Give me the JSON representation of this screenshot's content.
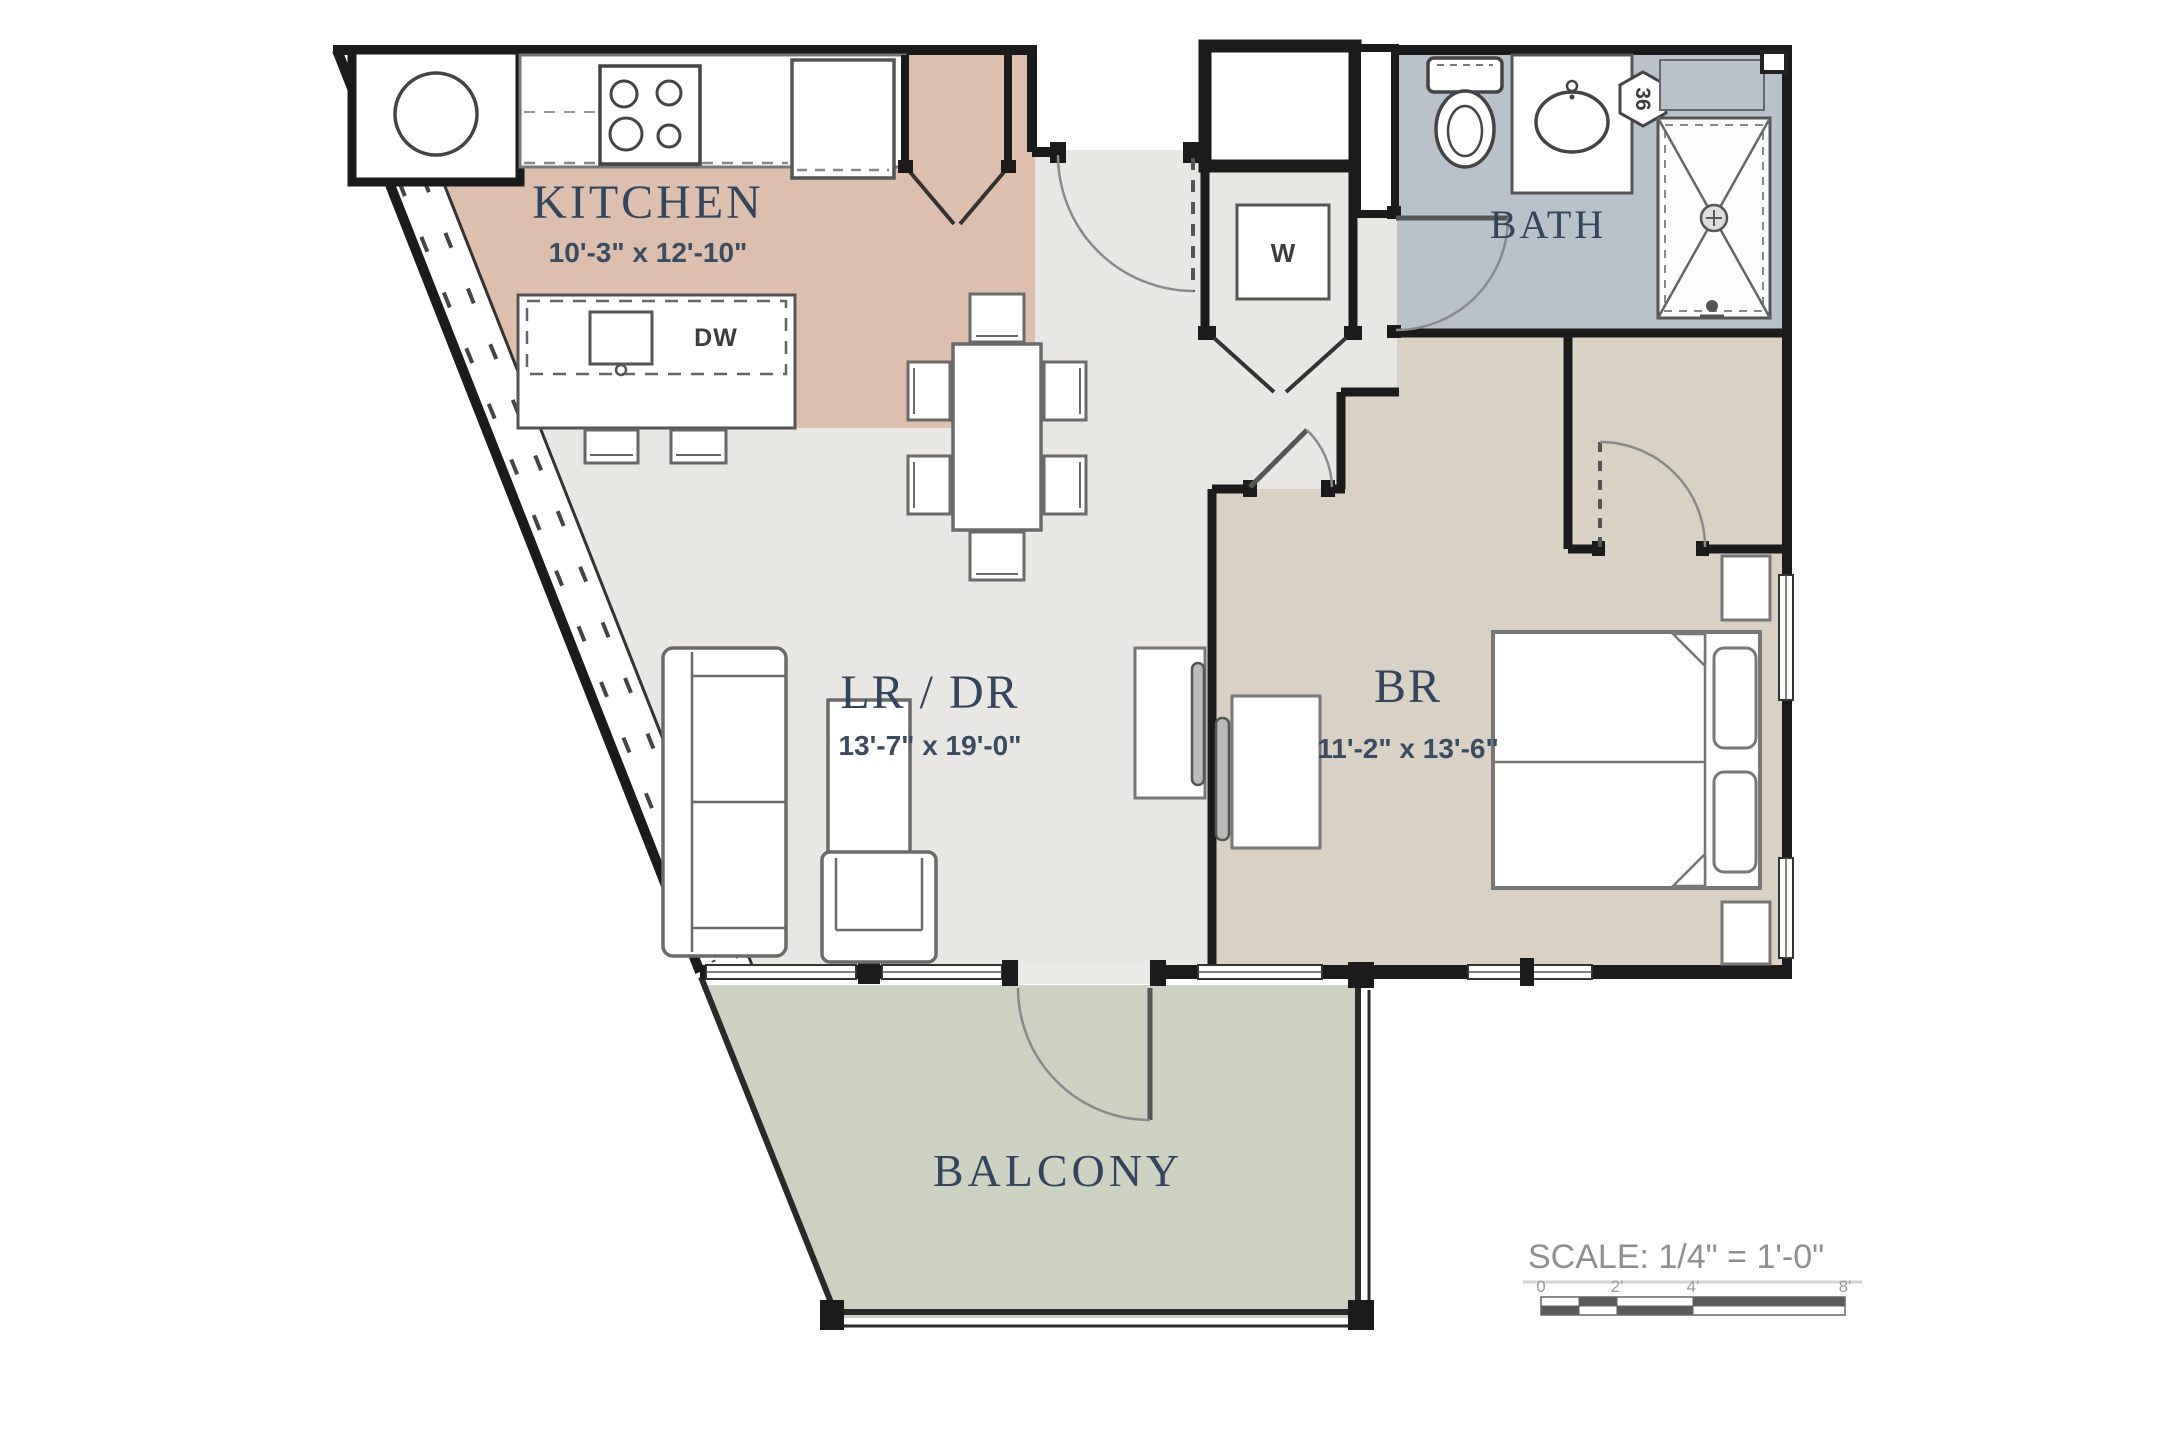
{
  "document": {
    "type": "apartment-floor-plan",
    "units": "feet-inches"
  },
  "colors": {
    "kitchen_floor": "#debfae",
    "bath_floor": "#b9c2cb",
    "living_floor": "#e9e7e3",
    "bedroom_floor": "#d9d1c3",
    "balcony_floor": "#cdd1c2",
    "wall": "#1b1b1b",
    "furniture_line": "#6a6a6a",
    "label_text": "#32455c",
    "dim_text": "#3a4c61",
    "scale_text": "#8f8f8f"
  },
  "rooms": [
    {
      "id": "kitchen",
      "name": "KITCHEN",
      "dimensions": "10'-3\" x 12'-10\""
    },
    {
      "id": "bath",
      "name": "BATH",
      "dimensions": ""
    },
    {
      "id": "living_dining",
      "name": "LR / DR",
      "dimensions": "13'-7\" x 19'-0\""
    },
    {
      "id": "bedroom",
      "name": "BR",
      "dimensions": "11'-2\" x 13'-6\""
    },
    {
      "id": "balcony",
      "name": "BALCONY",
      "dimensions": ""
    }
  ],
  "labels": {
    "washer": "W",
    "dishwasher": "DW",
    "vanity_width": "36"
  },
  "scale_bar": {
    "title": "SCALE: 1/4\"  =  1'-0\"",
    "ticks": [
      "0",
      "2'",
      "4'",
      "8'"
    ]
  }
}
